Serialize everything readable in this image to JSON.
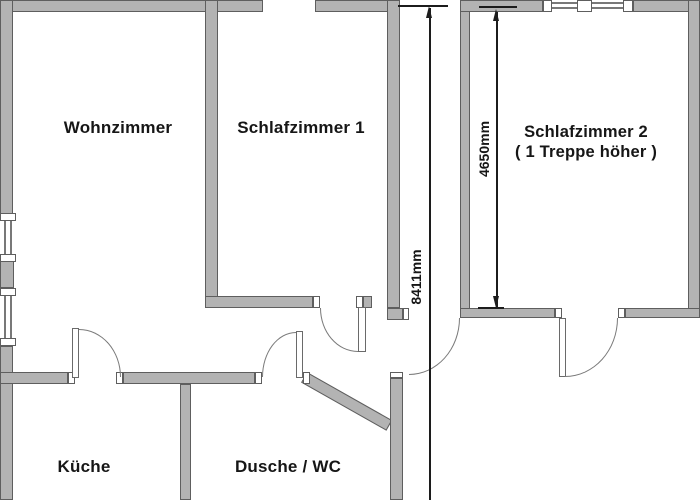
{
  "plan": {
    "colors": {
      "background": "#ffffff",
      "wall_fill": "#b3b3b3",
      "wall_edge": "#5e5e5e",
      "door_arc": "#7a7a7a",
      "dimension": "#1c1c1c",
      "label_text": "#161616"
    },
    "rooms": [
      {
        "id": "wohnzimmer",
        "label": "Wohnzimmer"
      },
      {
        "id": "schlafzimmer-1",
        "label": "Schlafzimmer 1"
      },
      {
        "id": "schlafzimmer-2",
        "label": "Schlafzimmer 2",
        "label2": "( 1 Treppe höher )"
      },
      {
        "id": "kueche",
        "label": "Küche"
      },
      {
        "id": "dusche-wc",
        "label": "Dusche / WC"
      }
    ],
    "dimensions": [
      {
        "id": "total-height",
        "label": "8411mm"
      },
      {
        "id": "schlafzimmer2-height",
        "label": "4650mm"
      }
    ]
  }
}
